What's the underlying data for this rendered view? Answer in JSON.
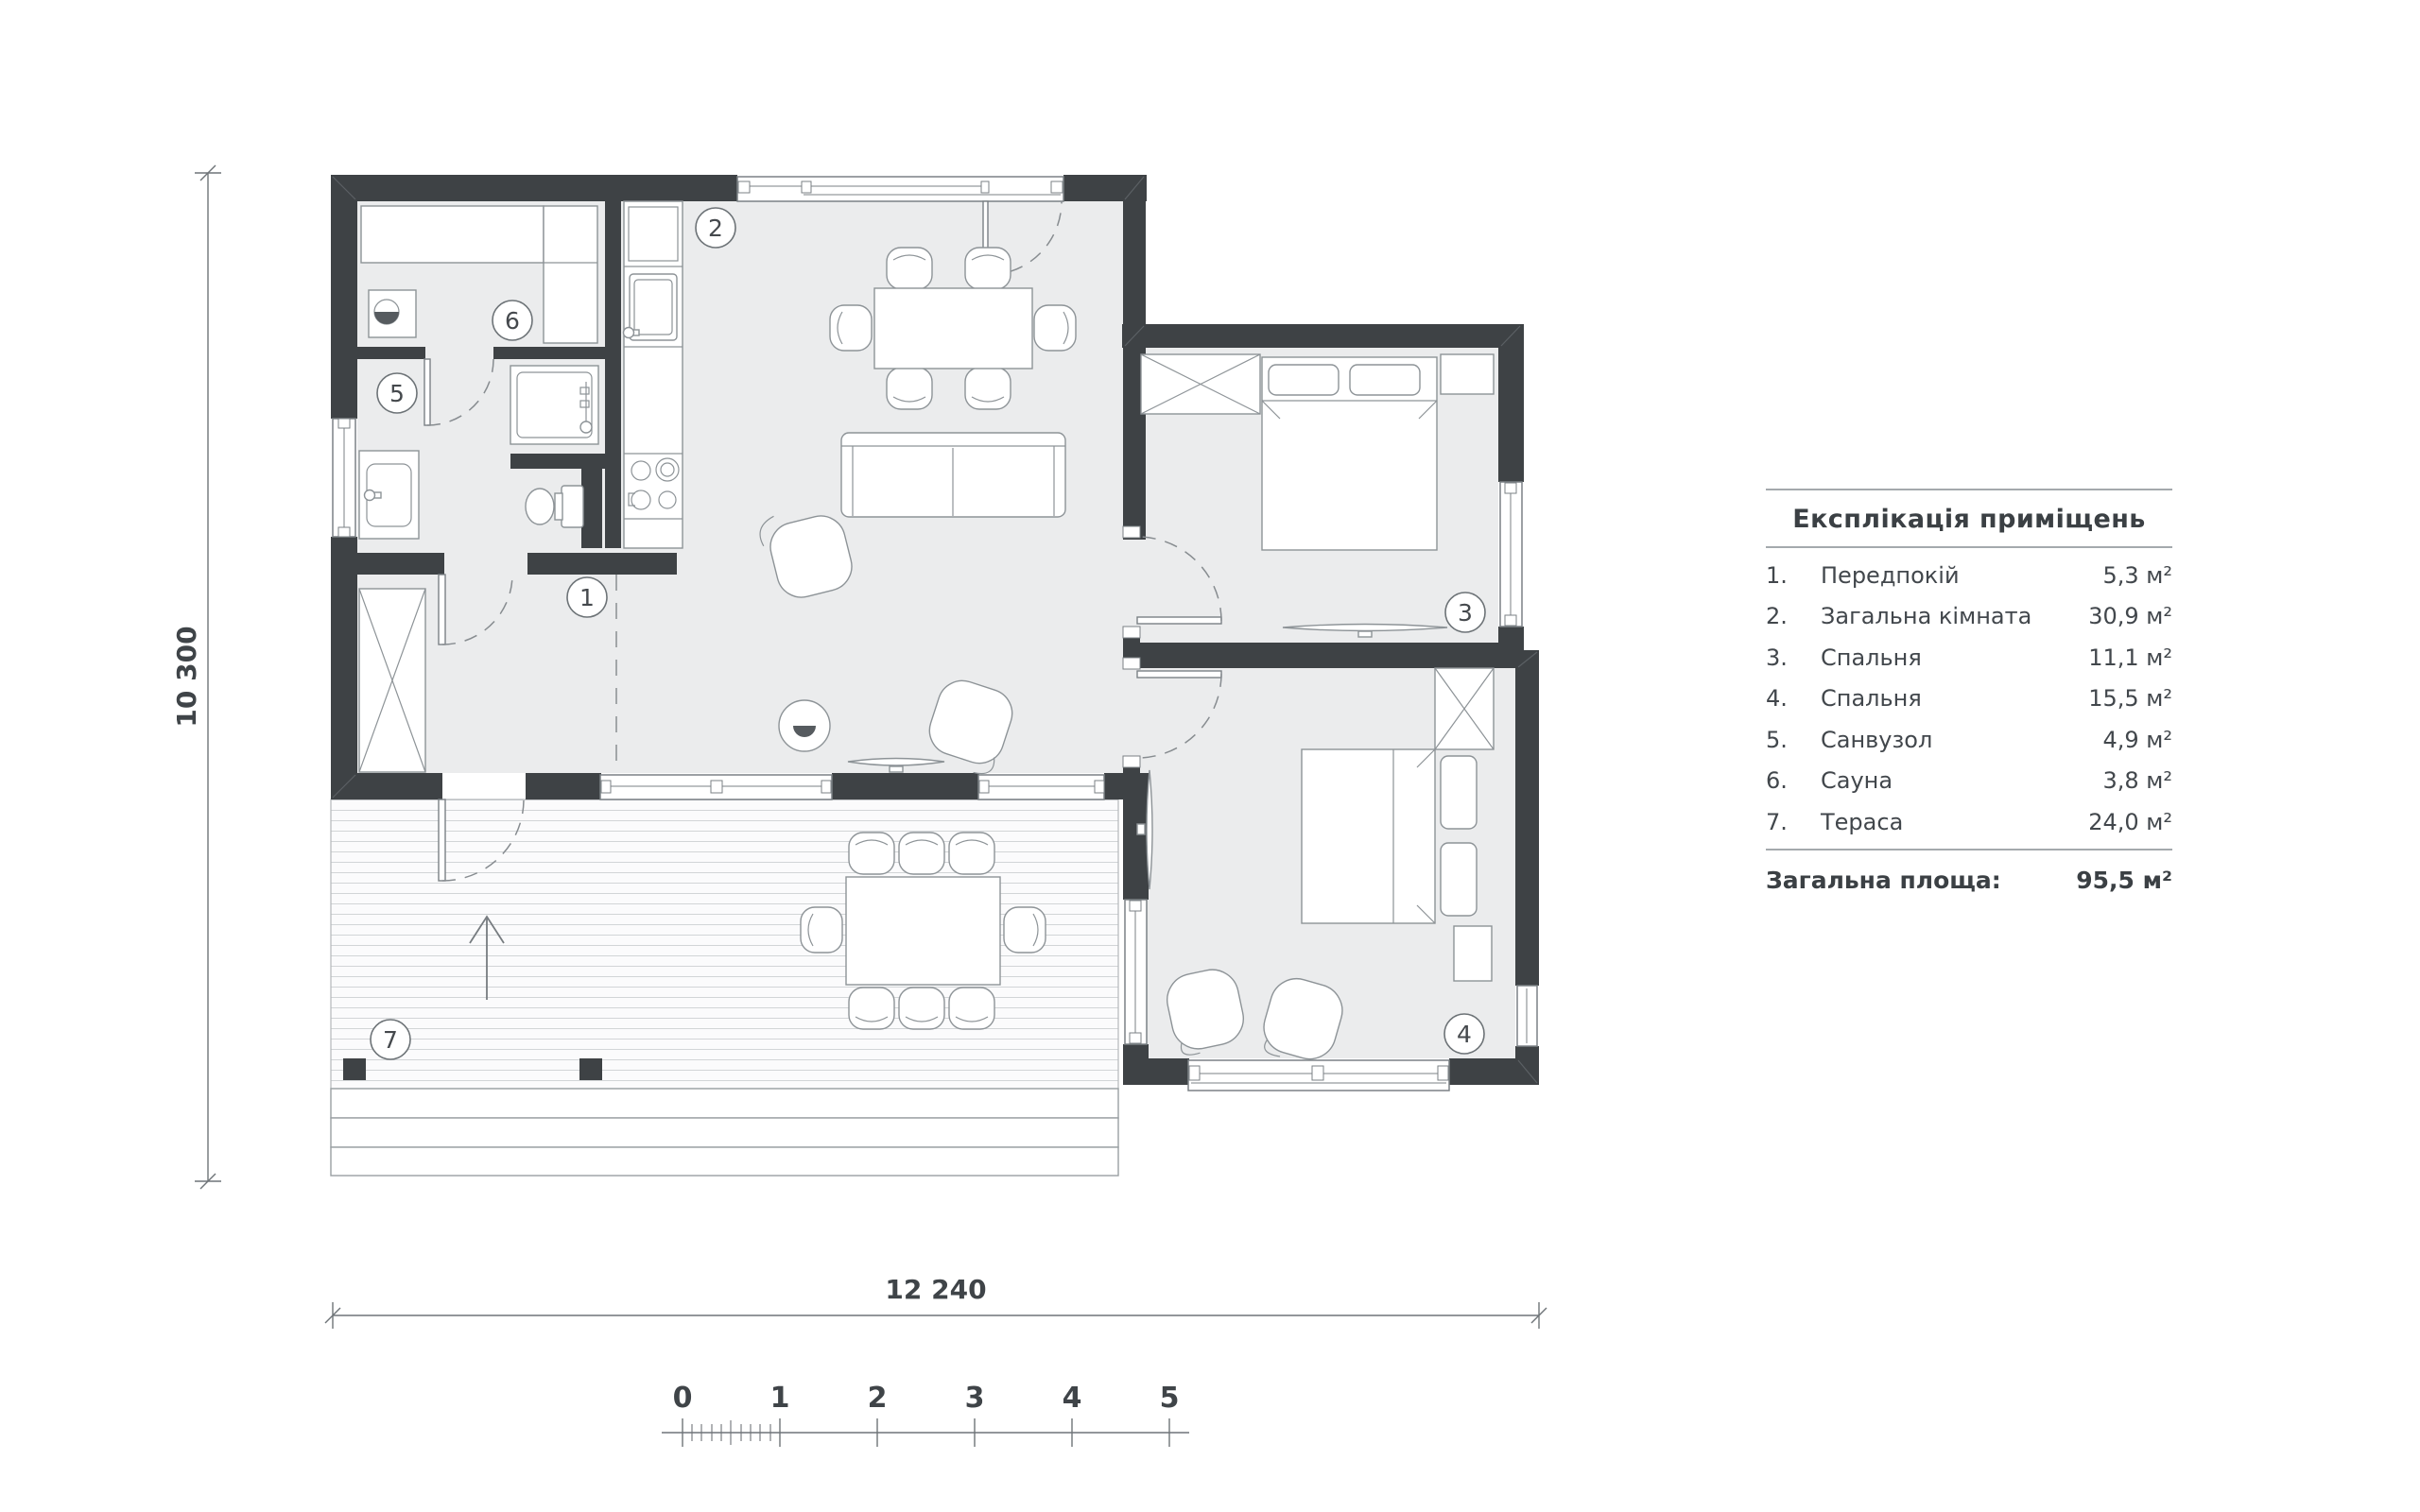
{
  "plan": {
    "dim_height_label": "10 300",
    "dim_width_label": "12 240",
    "scale_ticks": [
      "0",
      "1",
      "2",
      "3",
      "4",
      "5"
    ],
    "room_labels": [
      "1",
      "2",
      "3",
      "4",
      "5",
      "6",
      "7"
    ]
  },
  "legend": {
    "title": "Експлікація приміщень",
    "rows": [
      {
        "num": "1.",
        "name": "Передпокій",
        "area": "5,3 м²"
      },
      {
        "num": "2.",
        "name": "Загальна кімната",
        "area": "30,9 м²"
      },
      {
        "num": "3.",
        "name": "Спальня",
        "area": "11,1 м²"
      },
      {
        "num": "4.",
        "name": "Спальня",
        "area": "15,5 м²"
      },
      {
        "num": "5.",
        "name": "Санвузол",
        "area": "4,9 м²"
      },
      {
        "num": "6.",
        "name": "Сауна",
        "area": "3,8 м²"
      },
      {
        "num": "7.",
        "name": "Тераса",
        "area": "24,0 м²"
      }
    ],
    "total_label": "Загальна площа:",
    "total_value": "95,5 м²"
  },
  "colors": {
    "wall": "#3e4245",
    "floor": "#ebeced",
    "line": "#8d9397",
    "text": "#3f4448"
  }
}
